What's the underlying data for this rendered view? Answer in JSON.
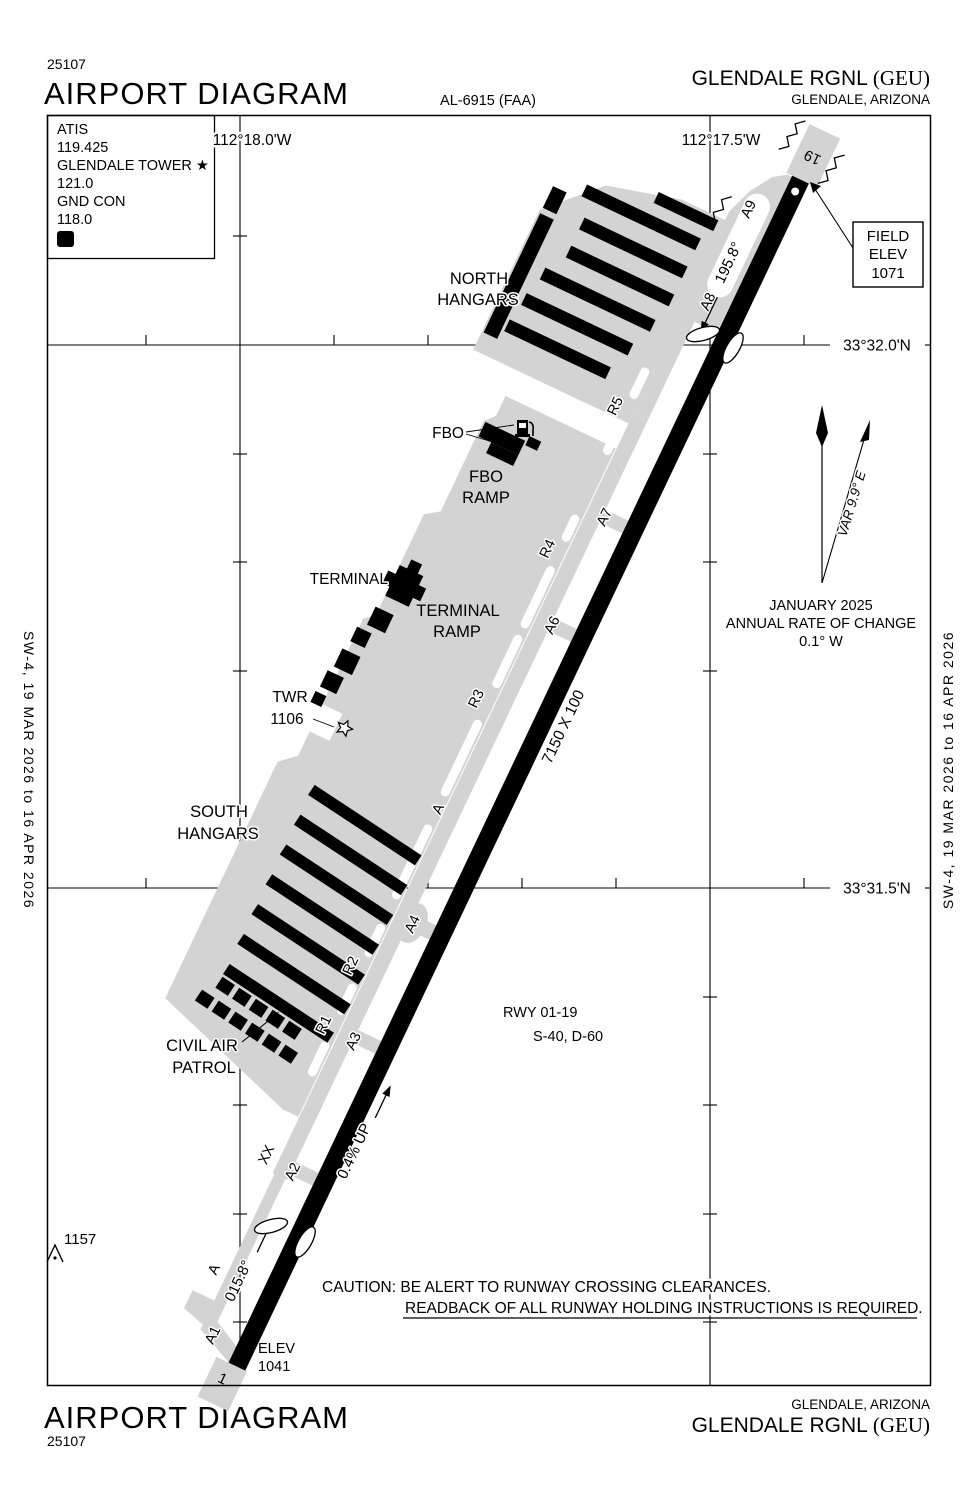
{
  "header": {
    "chart_number": "25107",
    "title": "AIRPORT DIAGRAM",
    "al_number": "AL-6915 (FAA)",
    "airport_name": "GLENDALE RGNL ",
    "airport_id": "(GEU)",
    "city_state": "GLENDALE, ARIZONA"
  },
  "footer": {
    "title": "AIRPORT DIAGRAM",
    "chart_number": "25107",
    "city_state": "GLENDALE, ARIZONA",
    "airport_name": "GLENDALE RGNL ",
    "airport_id": "(GEU)"
  },
  "margins": {
    "left_edition": "SW-4,  19 MAR 2026  to  16 APR 2026",
    "right_edition": "SW-4,  19 MAR 2026  to  16 APR 2026"
  },
  "comm": {
    "atis_label": "ATIS",
    "atis_freq": "119.425",
    "tower_label": "GLENDALE TOWER ★",
    "tower_freq": "121.0",
    "ground_label": "GND CON",
    "ground_freq": "118.0",
    "d_symbol": "D"
  },
  "grid": {
    "lon_left": "112°18.0'W",
    "lon_right": "112°17.5'W",
    "lat_top": "33°32.0'N",
    "lat_bottom": "33°31.5'N"
  },
  "runway": {
    "id_north_end": "19",
    "id_south_end": "1",
    "dimensions": "7150 X 100",
    "heading_south": "195.8°",
    "heading_north": "015.8°",
    "slope": "0.4% UP",
    "designation": "RWY 01-19",
    "strength": "S-40, D-60"
  },
  "elevations": {
    "field_elev_line1": "FIELD",
    "field_elev_line2": "ELEV",
    "field_elev_value": "1071",
    "rwy1_elev_label": "ELEV",
    "rwy1_elev_value": "1041",
    "obstacle_value": "1157",
    "twr_label": "TWR",
    "twr_value": "1106"
  },
  "taxiways": {
    "a9": "A9",
    "a8": "A8",
    "a7": "A7",
    "a6": "A6",
    "a4": "A4",
    "a3": "A3",
    "a2": "A2",
    "a1": "A1",
    "r5": "R5",
    "r4": "R4",
    "r3": "R3",
    "r2": "R2",
    "r1": "R1",
    "a_mid": "A",
    "a_south": "A",
    "closed_marker": "XX"
  },
  "areas": {
    "north_hangars_line1": "NORTH",
    "north_hangars_line2": "HANGARS",
    "fbo": "FBO",
    "fbo_ramp_line1": "FBO",
    "fbo_ramp_line2": "RAMP",
    "terminal": "TERMINAL",
    "terminal_ramp_line1": "TERMINAL",
    "terminal_ramp_line2": "RAMP",
    "south_hangars_line1": "SOUTH",
    "south_hangars_line2": "HANGARS",
    "cap_line1": "CIVIL AIR",
    "cap_line2": "PATROL"
  },
  "variation": {
    "var_label": "VAR 9.9° E",
    "line1": "JANUARY 2025",
    "line2": "ANNUAL RATE OF CHANGE",
    "line3": "0.1° W"
  },
  "caution": {
    "line1": "CAUTION: BE ALERT TO RUNWAY CROSSING CLEARANCES.",
    "line2": "READBACK OF ALL RUNWAY HOLDING INSTRUCTIONS IS REQUIRED."
  },
  "colors": {
    "pavement": "#d3d3d3",
    "ink": "#000000",
    "background": "#ffffff"
  }
}
